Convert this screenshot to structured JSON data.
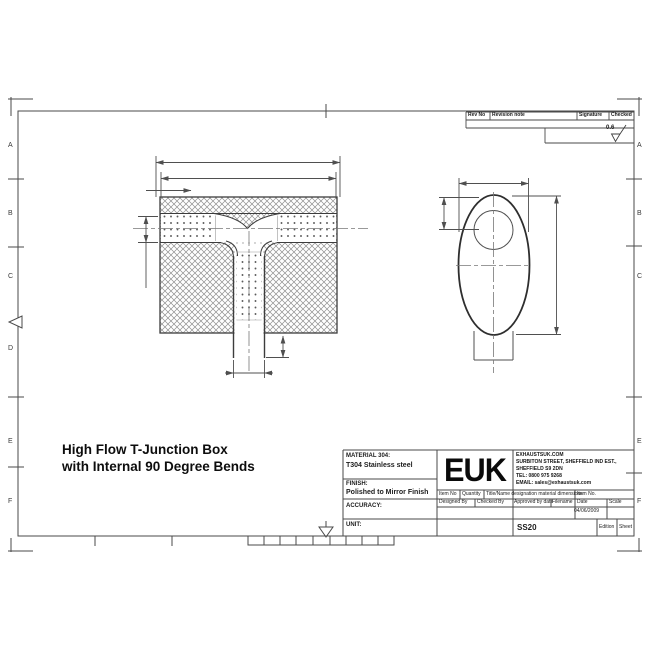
{
  "drawing_title": {
    "line1": "High Flow T-Junction Box",
    "line2": "with Internal 90 Degree Bends"
  },
  "sheet": {
    "left_zone_letters": [
      "A",
      "B",
      "C",
      "D",
      "E",
      "F"
    ],
    "right_zone_letters": [
      "A",
      "B",
      "C",
      "E",
      "F"
    ]
  },
  "revision_table": {
    "rev_no": "Rev No",
    "revision_note": "Revision note",
    "signature": "Signature",
    "checked": "Checked"
  },
  "surface_finish": {
    "value": "0.6"
  },
  "title_block": {
    "material_label": "MATERIAL 304:",
    "material_value": "T304 Stainless steel",
    "finish_label": "FINISH:",
    "finish_value": "Polished to Mirror Finish",
    "accuracy_label": "ACCURACY:",
    "unit_label": "UNIT:",
    "logo": "EUK",
    "company": {
      "line1": "EXHAUSTSUK.COM",
      "line2": "SURBITON STREET, SHEFFIELD IND EST.,",
      "line3": "SHEFFIELD S9 2DN",
      "line4": "TEL: 0800 975 9268",
      "line5": "EMAIL: sales@exhaustsuk.com"
    },
    "item_row": {
      "item_no": "Item No",
      "quantity": "Quantity",
      "title_name": "Title/Name designation material dimensions",
      "item_no_right": "Item No."
    },
    "approval_row": {
      "designed": "Designed By",
      "checked": "Checked By",
      "approved": "Approved by date",
      "filename": "Filename",
      "date": "Date",
      "scale": "Scale"
    },
    "date_value": "04/06/2009",
    "drawing_number": "SS20",
    "edition_label": "Edition",
    "sheet_label": "Sheet"
  }
}
